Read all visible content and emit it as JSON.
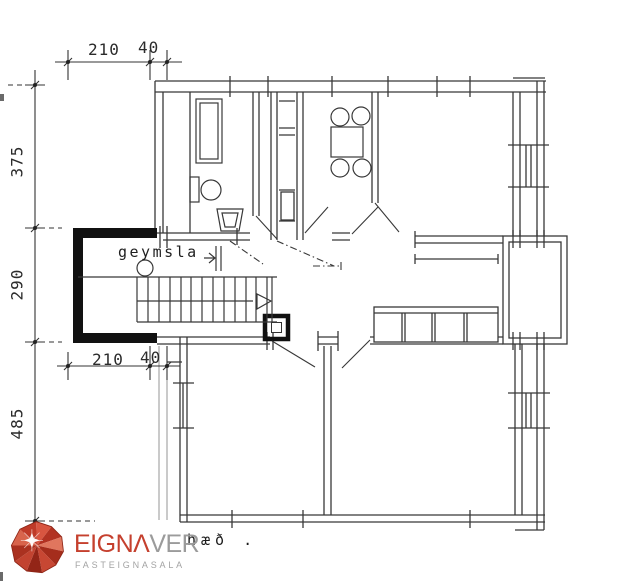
{
  "plan": {
    "dimensions": {
      "top_210": "210",
      "top_40": "40",
      "left_375": "375",
      "left_290": "290",
      "left_485": "485",
      "mid_210": "210",
      "mid_40": "40"
    },
    "labels": {
      "storage": "geymsla",
      "caption": "hæð ."
    }
  },
  "logo": {
    "primary": "EIGNΛ",
    "secondary": "VER",
    "tagline": "FASTEIGNASALA",
    "gem_icon": "red-faceted-gem",
    "colors": {
      "logo_red": "#c5402e",
      "logo_gray": "#9b9b9b",
      "ink": "#383838"
    }
  }
}
